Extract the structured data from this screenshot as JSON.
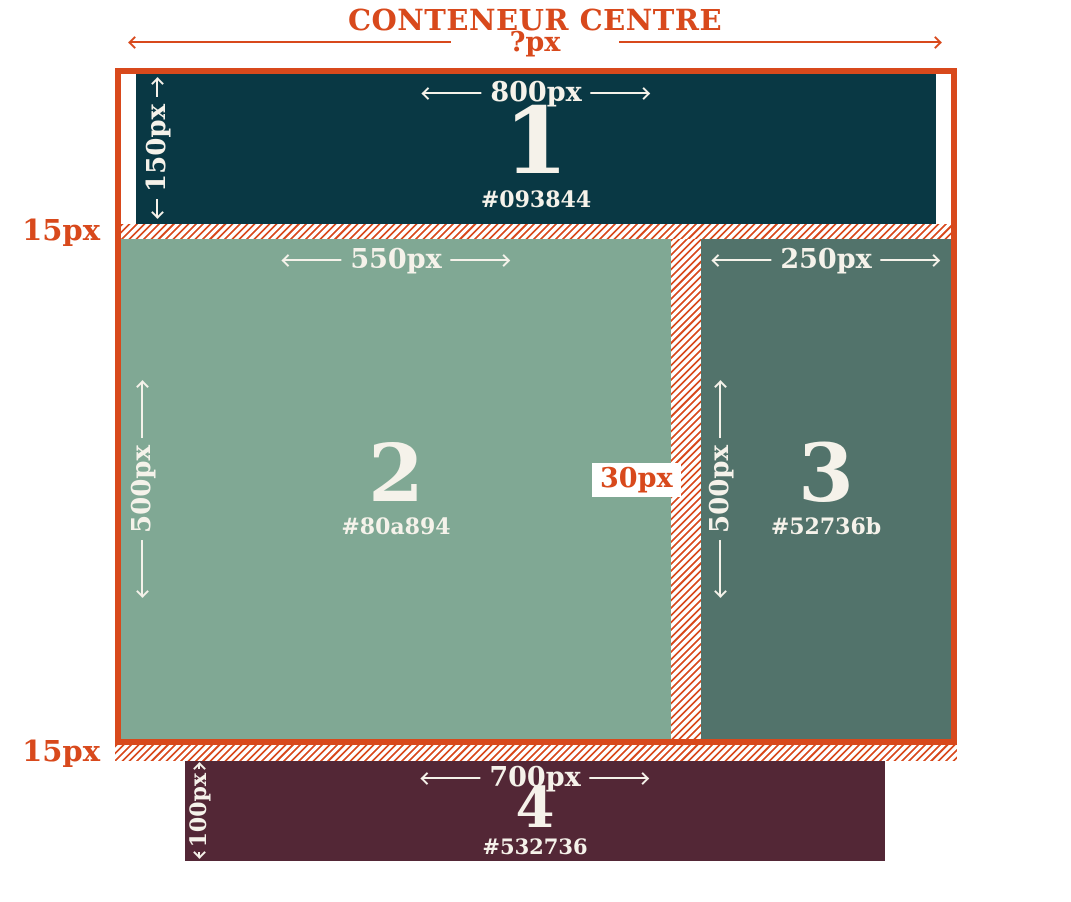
{
  "header": {
    "title": "CONTENEUR CENTRE",
    "width_label": "?px"
  },
  "labels": {
    "gap_top": "15px",
    "gap_bottom": "15px",
    "gutter": "30px"
  },
  "colors": {
    "accent_orange": "#d8491c",
    "text_cream": "#f5f2ea",
    "page_background": "#ffffff"
  },
  "boxes": [
    {
      "number": "1",
      "hex": "#093844",
      "color": "#093844",
      "width": "800px",
      "height": "150px"
    },
    {
      "number": "2",
      "hex": "#80a894",
      "color": "#80a894",
      "width": "550px",
      "height": "500px"
    },
    {
      "number": "3",
      "hex": "#52736b",
      "color": "#52736b",
      "width": "250px",
      "height": "500px"
    },
    {
      "number": "4",
      "hex": "#532736",
      "color": "#532736",
      "width": "700px",
      "height": "100px"
    }
  ]
}
